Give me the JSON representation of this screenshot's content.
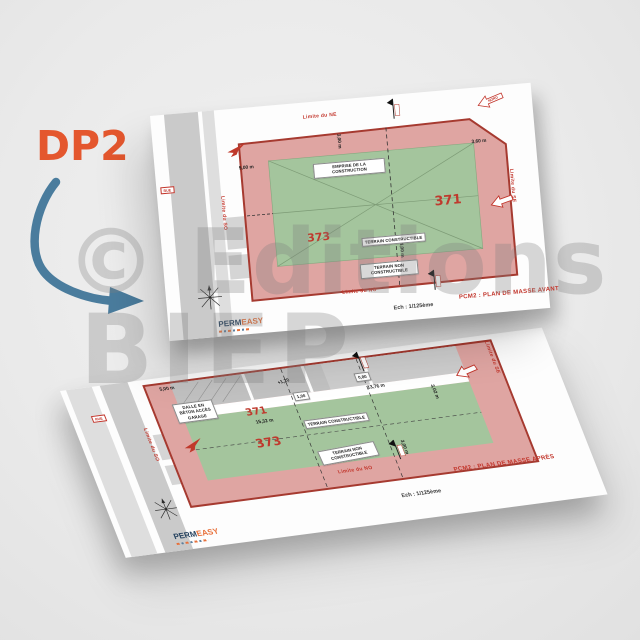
{
  "annotation": {
    "label": "DP2"
  },
  "watermark": {
    "line1": "© Editions",
    "line2": "BIEP"
  },
  "brand": {
    "name_left": "PERM",
    "name_right": "EASY"
  },
  "plan_avant": {
    "title": "PCM2 : PLAN DE MASSE AVANT",
    "scale": "Ech : 1/125ème",
    "north": "NORD",
    "road": "RUE",
    "parcel_right": "371",
    "parcel_left": "373",
    "emprise": "EMPRISE DE LA CONSTRUCTION",
    "constructible": "TERRAIN CONSTRUCTIBLE",
    "non_constructible": "TERRAIN NON CONSTRUCTIBLE",
    "limite_ne": "Limite du NE",
    "limite_se": "Limite du SE",
    "limite_no": "Limite du NO",
    "limite_so": "Limite du SO",
    "dim_5m": "5,00 m",
    "dim_3m": "3,00 m",
    "dim_360": "3,60 m",
    "dim_4m": "4,00 m"
  },
  "plan_apres": {
    "title": "PCM2 : PLAN DE MASSE APRÈS",
    "scale": "Ech : 1/125ème",
    "road": "RUE",
    "parcel_right": "371",
    "parcel_left": "373",
    "constructible": "TERRAIN CONSTRUCTIBLE",
    "non_constructible": "TERRAIN NON CONSTRUCTIBLE",
    "dalle": "DALLE EN BÉTON ACCÈS GARAGE",
    "limite_se": "Limite du SE",
    "limite_no": "Limite du NO",
    "limite_so": "Limite du SO",
    "dim_5m": "5,00 m",
    "dim_1532": "15,32 m",
    "dim_1376": "13,76 m",
    "dim_302": "3,02 m",
    "dim_3m": "3,00 m",
    "dim_100": "1,00",
    "dim_080": "0,80",
    "dim_120": "+1,20"
  }
}
